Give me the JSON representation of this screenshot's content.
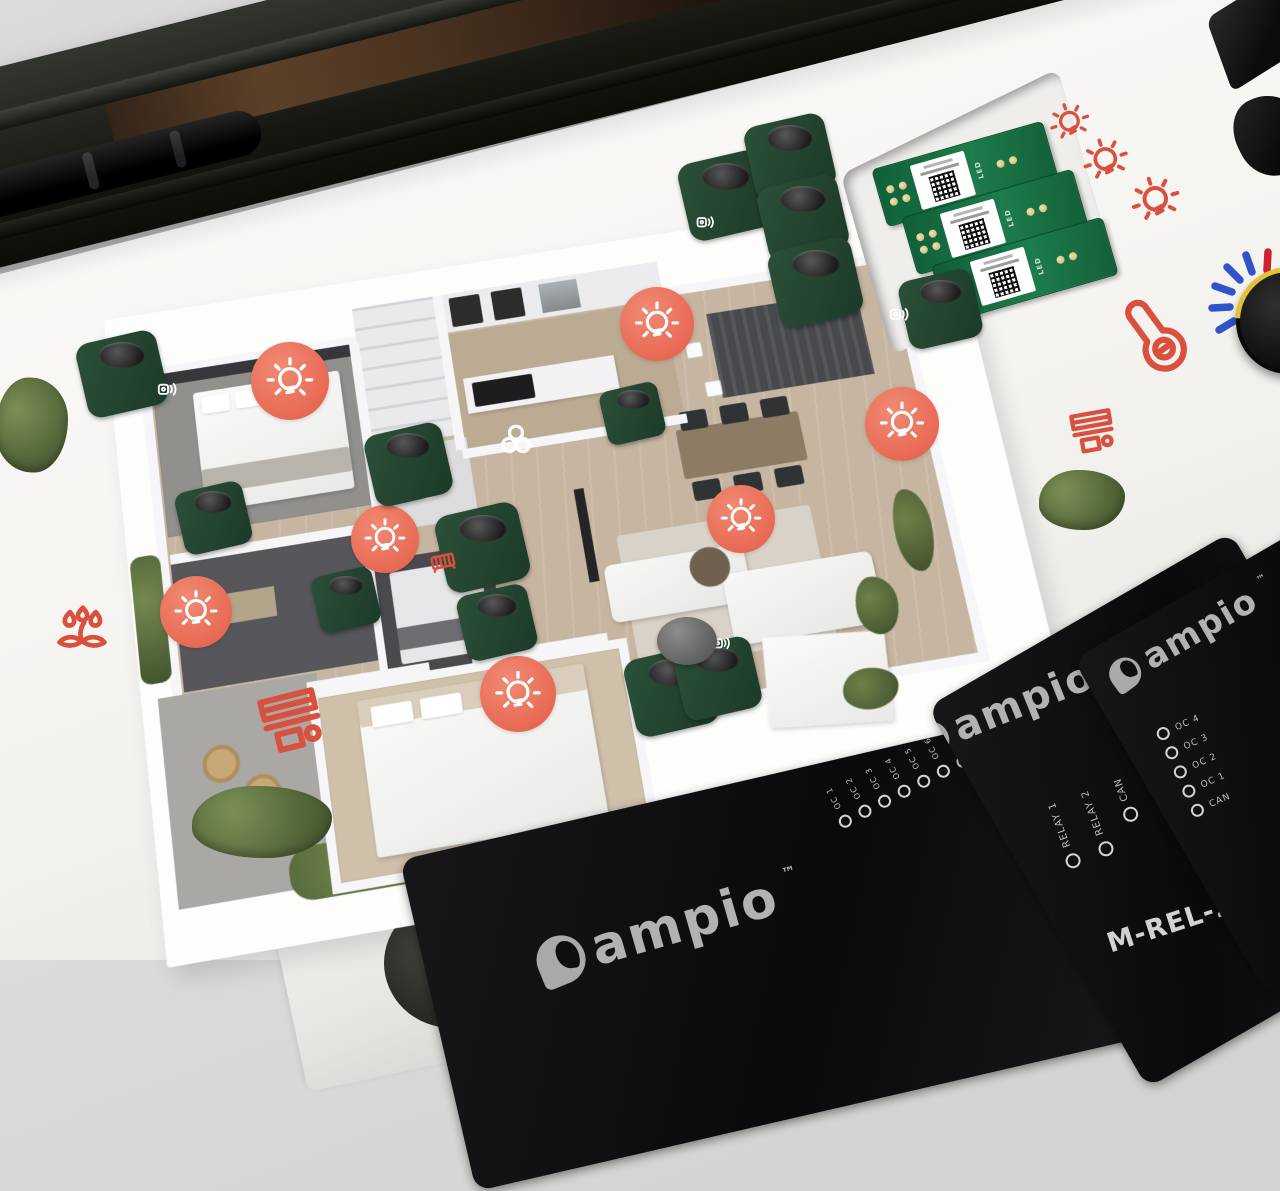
{
  "branding": {
    "logo_text": "ampio",
    "tm": "™"
  },
  "panels": {
    "relay_module": {
      "title": "M-REL-2s",
      "leds": [
        "RELAY 1",
        "RELAY 2",
        "CAN"
      ]
    },
    "oc_module": {
      "leds": [
        "OC 1",
        "OC 2",
        "OC 3",
        "OC 4",
        "OC 5",
        "OC 6",
        "OC 7",
        "OC 8",
        "CAN"
      ]
    },
    "side_module": {
      "leds": [
        "OC 4",
        "OC 3",
        "OC 2",
        "OC 1",
        "CAN"
      ]
    }
  },
  "pcb": {
    "silk_label": "LED",
    "count": 3
  },
  "palette": {
    "accent_coral": "#E8695A",
    "pcb_green": "#1B7A4B",
    "print_red": "#D9503F",
    "dash_blue": "#2F53C9",
    "dash_red": "#CC2233"
  },
  "overlay": {
    "items": [
      {
        "type": "badge",
        "icon": "sym-bulb",
        "name": "light-scene-badge",
        "interactable": false,
        "x": 290,
        "y": 381,
        "s": 78
      },
      {
        "type": "badge",
        "icon": "sym-bulb",
        "name": "light-scene-badge",
        "interactable": false,
        "x": 657,
        "y": 324,
        "s": 74
      },
      {
        "type": "badge",
        "icon": "sym-bulb",
        "name": "light-scene-badge",
        "interactable": false,
        "x": 902,
        "y": 424,
        "s": 74
      },
      {
        "type": "badge",
        "icon": "sym-bulb",
        "name": "light-scene-badge",
        "interactable": false,
        "x": 741,
        "y": 519,
        "s": 68
      },
      {
        "type": "badge",
        "icon": "sym-bulb",
        "name": "light-scene-badge",
        "interactable": false,
        "x": 385,
        "y": 539,
        "s": 68
      },
      {
        "type": "badge",
        "icon": "sym-bulb",
        "name": "light-scene-badge",
        "interactable": false,
        "x": 196,
        "y": 612,
        "s": 72
      },
      {
        "type": "badge",
        "icon": "sym-bulb",
        "name": "light-scene-badge",
        "interactable": false,
        "x": 518,
        "y": 694,
        "s": 76
      },
      {
        "type": "knob",
        "name": "push-button-knob",
        "interactable": true,
        "x": 122,
        "y": 374,
        "s": 50
      },
      {
        "type": "knob",
        "name": "push-button-knob",
        "interactable": true,
        "x": 726,
        "y": 196,
        "s": 52
      },
      {
        "type": "knob",
        "name": "push-button-knob",
        "interactable": true,
        "x": 790,
        "y": 157,
        "s": 50
      },
      {
        "type": "knob",
        "name": "push-button-knob",
        "interactable": true,
        "x": 803,
        "y": 218,
        "s": 50
      },
      {
        "type": "knob",
        "name": "push-button-knob",
        "interactable": true,
        "x": 816,
        "y": 283,
        "s": 52
      },
      {
        "type": "knob",
        "name": "push-button-knob",
        "interactable": true,
        "x": 941,
        "y": 309,
        "s": 46
      },
      {
        "type": "knob",
        "name": "push-button-knob",
        "interactable": true,
        "x": 633,
        "y": 413,
        "s": 36
      },
      {
        "type": "knob",
        "name": "push-button-knob",
        "interactable": true,
        "x": 408,
        "y": 464,
        "s": 48
      },
      {
        "type": "knob",
        "name": "push-button-knob",
        "interactable": true,
        "x": 213,
        "y": 518,
        "s": 42
      },
      {
        "type": "knob",
        "name": "push-button-knob",
        "interactable": true,
        "x": 483,
        "y": 548,
        "s": 52
      },
      {
        "type": "knob",
        "name": "push-button-knob",
        "interactable": true,
        "x": 346,
        "y": 600,
        "s": 38
      },
      {
        "type": "knob",
        "name": "push-button-knob",
        "interactable": true,
        "x": 497,
        "y": 622,
        "s": 44
      },
      {
        "type": "knob",
        "name": "push-button-knob",
        "interactable": true,
        "x": 672,
        "y": 692,
        "s": 52
      },
      {
        "type": "knob",
        "name": "push-button-knob",
        "interactable": true,
        "x": 717,
        "y": 678,
        "s": 48
      },
      {
        "type": "speaker",
        "icon": "sym-speaker",
        "name": "speaker-icon",
        "interactable": false,
        "x": 168,
        "y": 389,
        "s": 26
      },
      {
        "type": "speaker",
        "icon": "sym-speaker",
        "name": "speaker-icon",
        "interactable": false,
        "x": 706,
        "y": 222,
        "s": 24
      },
      {
        "type": "speaker",
        "icon": "sym-speaker",
        "name": "speaker-icon",
        "interactable": false,
        "x": 900,
        "y": 314,
        "s": 26
      },
      {
        "type": "speaker",
        "icon": "sym-speaker",
        "name": "speaker-icon",
        "interactable": false,
        "x": 722,
        "y": 643,
        "s": 24
      },
      {
        "type": "fan",
        "icon": "sym-fan",
        "name": "fan-icon",
        "interactable": false,
        "x": 516,
        "y": 440,
        "s": 46
      },
      {
        "type": "bulb-o",
        "icon": "sym-bulb",
        "name": "light-bulb-icon",
        "interactable": false,
        "x": 1070,
        "y": 123,
        "s": 46,
        "r": -18
      },
      {
        "type": "bulb-o",
        "icon": "sym-bulb",
        "name": "light-bulb-icon",
        "interactable": false,
        "x": 1106,
        "y": 161,
        "s": 52,
        "r": -18
      },
      {
        "type": "bulb-o",
        "icon": "sym-bulb",
        "name": "light-bulb-icon",
        "interactable": false,
        "x": 1156,
        "y": 201,
        "s": 56,
        "r": -18
      },
      {
        "type": "thermo",
        "icon": "sym-thermo",
        "name": "thermometer-icon",
        "interactable": false,
        "x": 1152,
        "y": 332,
        "s": 88,
        "r": -36
      },
      {
        "type": "blinds",
        "icon": "sym-blinds",
        "name": "roller-blind-icon",
        "interactable": false,
        "x": 1093,
        "y": 432,
        "s": 60,
        "r": -10
      },
      {
        "type": "blinds",
        "icon": "sym-blinds",
        "name": "roller-blind-icon",
        "interactable": false,
        "x": 292,
        "y": 722,
        "s": 84,
        "r": -14
      },
      {
        "type": "plantic",
        "icon": "sym-plant",
        "name": "irrigation-icon",
        "interactable": false,
        "x": 82,
        "y": 628,
        "s": 66
      },
      {
        "type": "radiator",
        "icon": "sym-radiator",
        "name": "radiator-icon",
        "interactable": false,
        "x": 443,
        "y": 562,
        "s": 34,
        "r": -12
      },
      {
        "type": "shrub",
        "name": "shrub",
        "interactable": false,
        "x": 32,
        "y": 425,
        "w": 72,
        "h": 95
      },
      {
        "type": "shrub",
        "name": "shrub",
        "interactable": false,
        "x": 262,
        "y": 822,
        "w": 140,
        "h": 72
      },
      {
        "type": "shrub",
        "name": "shrub",
        "interactable": false,
        "x": 1082,
        "y": 500,
        "w": 86,
        "h": 60
      },
      {
        "type": "sub",
        "name": "subwoofer",
        "interactable": false,
        "x": 687,
        "y": 641,
        "w": 60,
        "h": 48
      }
    ]
  }
}
